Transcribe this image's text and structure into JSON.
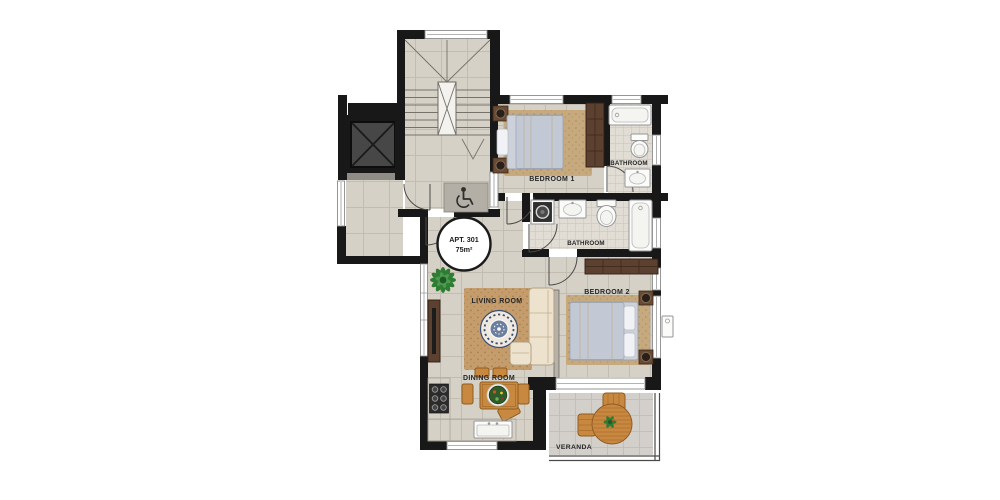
{
  "floorplan": {
    "badge": {
      "title": "APT. 301",
      "area": "75m²"
    },
    "labels": {
      "bedroom1": "BEDROOM 1",
      "bathroom1": "BATHROOM",
      "bathroom2": "BATHROOM",
      "bedroom2": "BEDROOM 2",
      "living": "LIVING ROOM",
      "dining": "DINING ROOM",
      "veranda": "VERANDA"
    },
    "icons": {
      "wheelchair": "wheelchair-accessible-icon",
      "elevator": "elevator-x-icon",
      "stairs_arrow": "stairs-down-arrow-icon"
    },
    "colors": {
      "wall": "#181818",
      "floor": "#d6d1c7",
      "grout": "#c2bcb1",
      "bath": "#e1ddd5",
      "ver": "#d3d0cb",
      "rug": "#c7a97e",
      "rugliv": "#c59c6b",
      "woodd": "#5d4130",
      "woodl": "#c8883f",
      "sofa": "#ece2cd",
      "bed": "#cdd2da",
      "plant": "#2e7d32",
      "elev": "#474747"
    }
  }
}
